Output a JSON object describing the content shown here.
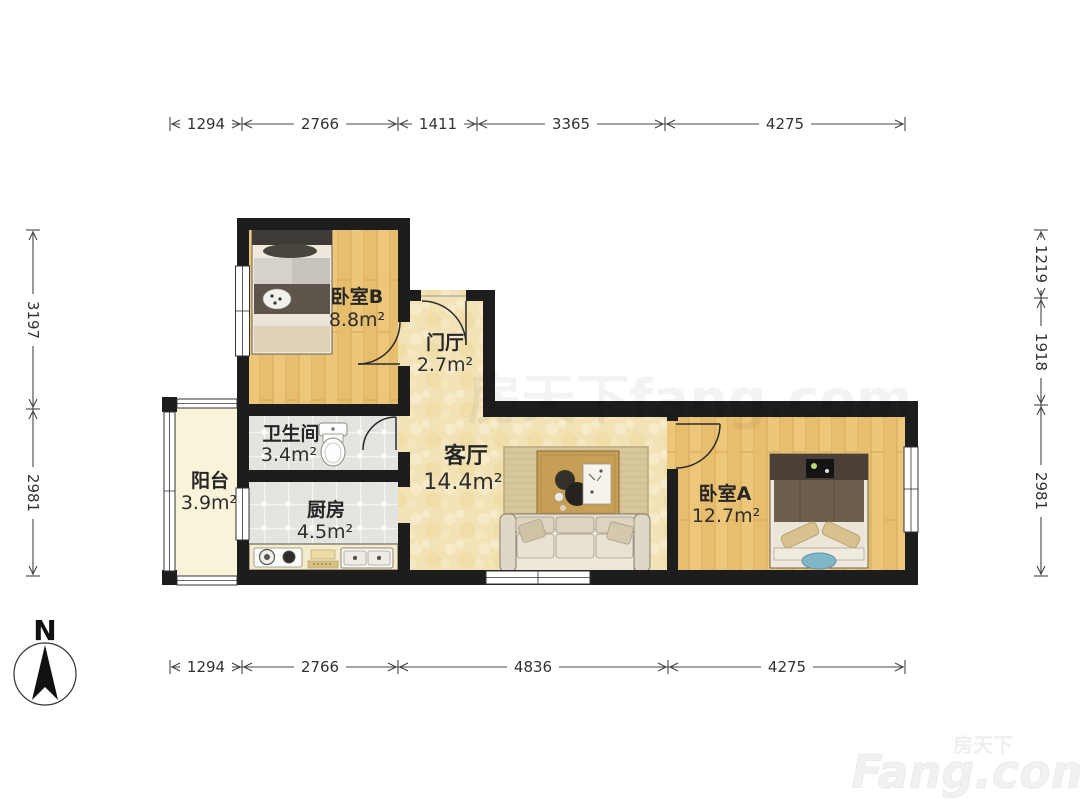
{
  "rooms": {
    "bedroom_b": {
      "label": "卧室B",
      "area": "8.8m²"
    },
    "entry_hall": {
      "label": "门厅",
      "area": "2.7m²"
    },
    "bathroom": {
      "label": "卫生间",
      "area": "3.4m²"
    },
    "balcony": {
      "label": "阳台",
      "area": "3.9m²"
    },
    "kitchen": {
      "label": "厨房",
      "area": "4.5m²"
    },
    "living_room": {
      "label": "客厅",
      "area": "14.4m²"
    },
    "bedroom_a": {
      "label": "卧室A",
      "area": "12.7m²"
    }
  },
  "dimensions_mm": {
    "top": [
      "1294",
      "2766",
      "1411",
      "3365",
      "4275"
    ],
    "bottom": [
      "1294",
      "2766",
      "4836",
      "4275"
    ],
    "left": [
      "3197",
      "2981"
    ],
    "right": [
      "1219",
      "1918",
      "2981"
    ]
  },
  "compass": {
    "north_label": "N"
  },
  "watermarks": {
    "center": "房天下fang.com",
    "corner_cn": "房天下",
    "corner_en": "Fang.com"
  },
  "palette": {
    "wall": "#1d1d1d",
    "wood_floor": "#ecc679",
    "stone_floor": "#f2e2b6",
    "tile_floor": "#e3e3e0",
    "balcony_floor": "#f8f3d9"
  }
}
